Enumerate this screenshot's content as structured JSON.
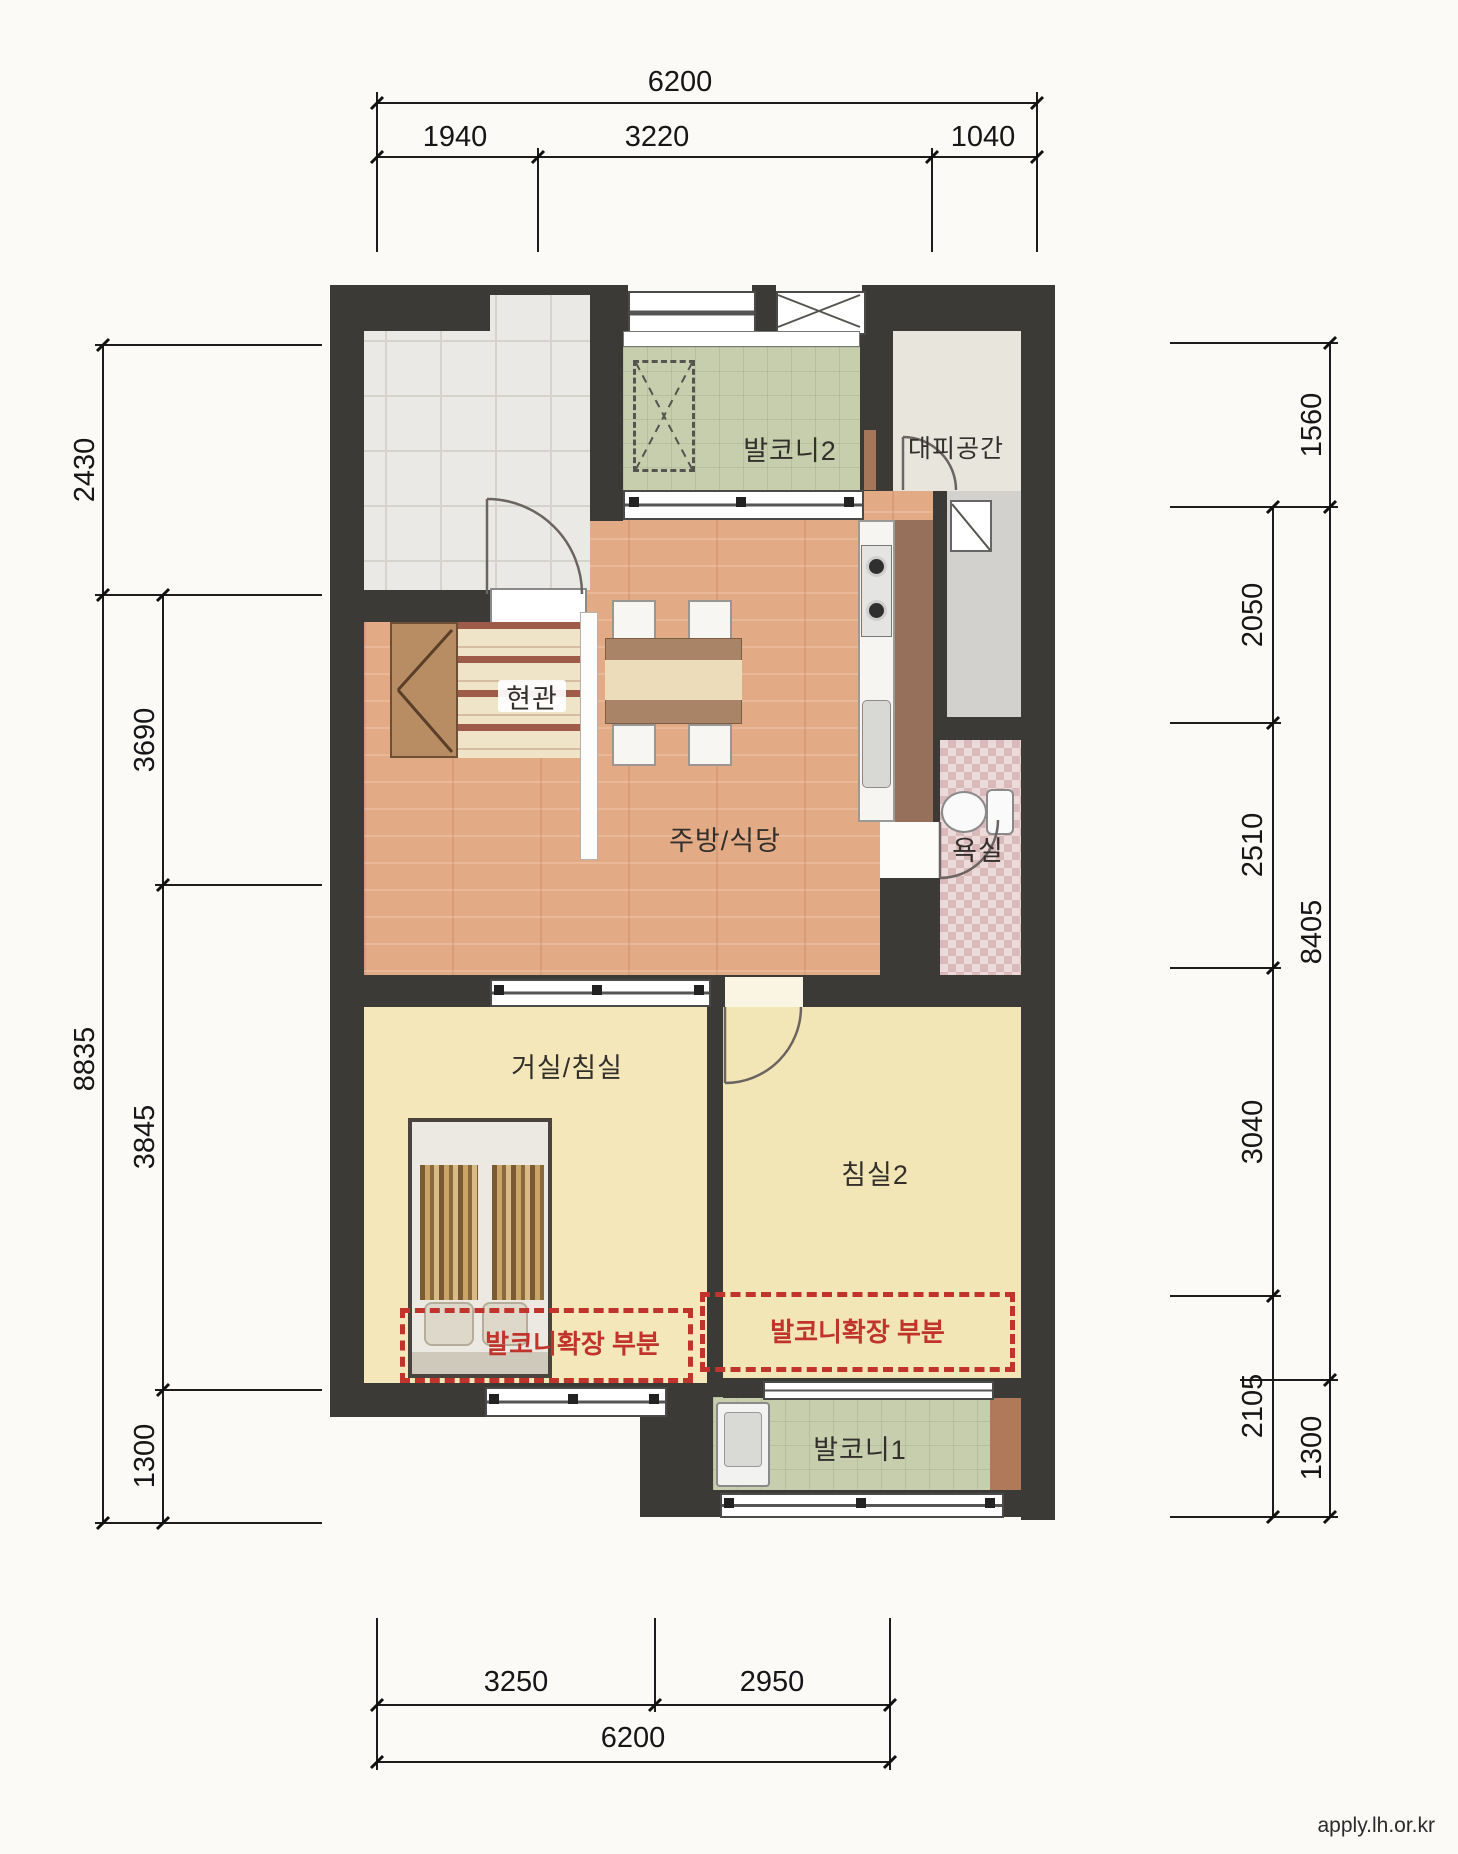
{
  "page": {
    "footer_url": "apply.lh.or.kr"
  },
  "plan": {
    "type": "apartment-floor-plan",
    "rooms": {
      "balcony2": {
        "label": "발코니2"
      },
      "refuge": {
        "label": "대피공간"
      },
      "entrance": {
        "label": "현관"
      },
      "kitchen_dining": {
        "label": "주방/식당"
      },
      "bathroom": {
        "label": "욕실"
      },
      "living_bedroom": {
        "label": "거실/침실"
      },
      "bedroom2": {
        "label": "침실2"
      },
      "balcony_extension_left": {
        "label": "발코니확장 부분"
      },
      "balcony_extension_right": {
        "label": "발코니확장 부분"
      },
      "balcony1": {
        "label": "발코니1"
      }
    },
    "fixtures": [
      "shoe-cabinet",
      "entrance-mat",
      "dining-table",
      "chairs",
      "kitchen-counter",
      "stove",
      "sink",
      "tall-cabinet",
      "toilet",
      "bed",
      "pillows",
      "washing-machine",
      "ac-outdoor-unit",
      "utility-fixture"
    ]
  },
  "dimensions": {
    "top": {
      "total": "6200",
      "segments": [
        "1940",
        "3220",
        "1040"
      ]
    },
    "bottom": {
      "total": "6200",
      "segments": [
        "3250",
        "2950"
      ]
    },
    "left": {
      "outer": [
        "2430",
        "8835"
      ],
      "inner": [
        "3690",
        "3845",
        "1300"
      ]
    },
    "right": {
      "outer": [
        "1560",
        "8405",
        "1300"
      ],
      "inner": [
        "2050",
        "2510",
        "3040",
        "2105"
      ]
    }
  },
  "colors": {
    "wall": "#3b3a37",
    "wood_floor": "#e3aa86",
    "bedroom_floor": "#f4e8bb",
    "balcony_floor": "#c6cead",
    "bathroom_tile": "#ecd9d9",
    "extension_dash": "#c0342b"
  }
}
